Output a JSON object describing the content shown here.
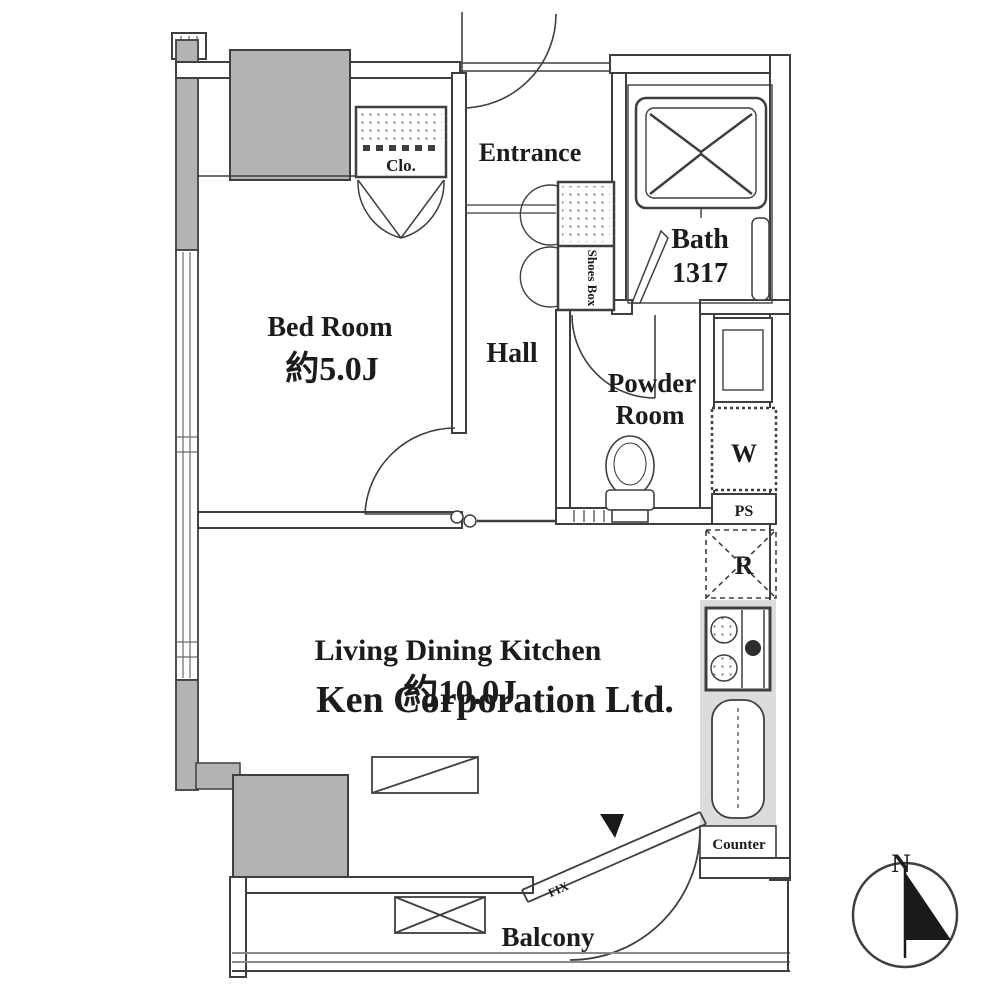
{
  "colors": {
    "wall_line": "#3f3f3f",
    "pillar_fill": "#b3b3b3",
    "kitchen_strip": "#dcdcdc",
    "watermark": "#d9d9d9",
    "paper": "#ffffff"
  },
  "rooms": {
    "entrance": {
      "label": "Entrance"
    },
    "hall": {
      "label": "Hall"
    },
    "bed_room": {
      "name": "Bed Room",
      "size": "約5.0J"
    },
    "bath": {
      "name": "Bath",
      "size": "1317"
    },
    "powder_room": {
      "line1": "Powder",
      "line2": "Room"
    },
    "ldk": {
      "name": "Living Dining Kitchen",
      "size": "約10.0J"
    },
    "balcony": {
      "label": "Balcony"
    }
  },
  "fixtures": {
    "closet_label": "Clo.",
    "shoes_box_label": "Shoes Box",
    "washer_label": "W",
    "pipe_space_label": "PS",
    "refrigerator_label": "R",
    "counter_label": "Counter",
    "fixed_window_label": "FIX"
  },
  "compass": {
    "north_label": "N"
  },
  "watermark": {
    "text": "Ken Corporation Ltd."
  }
}
